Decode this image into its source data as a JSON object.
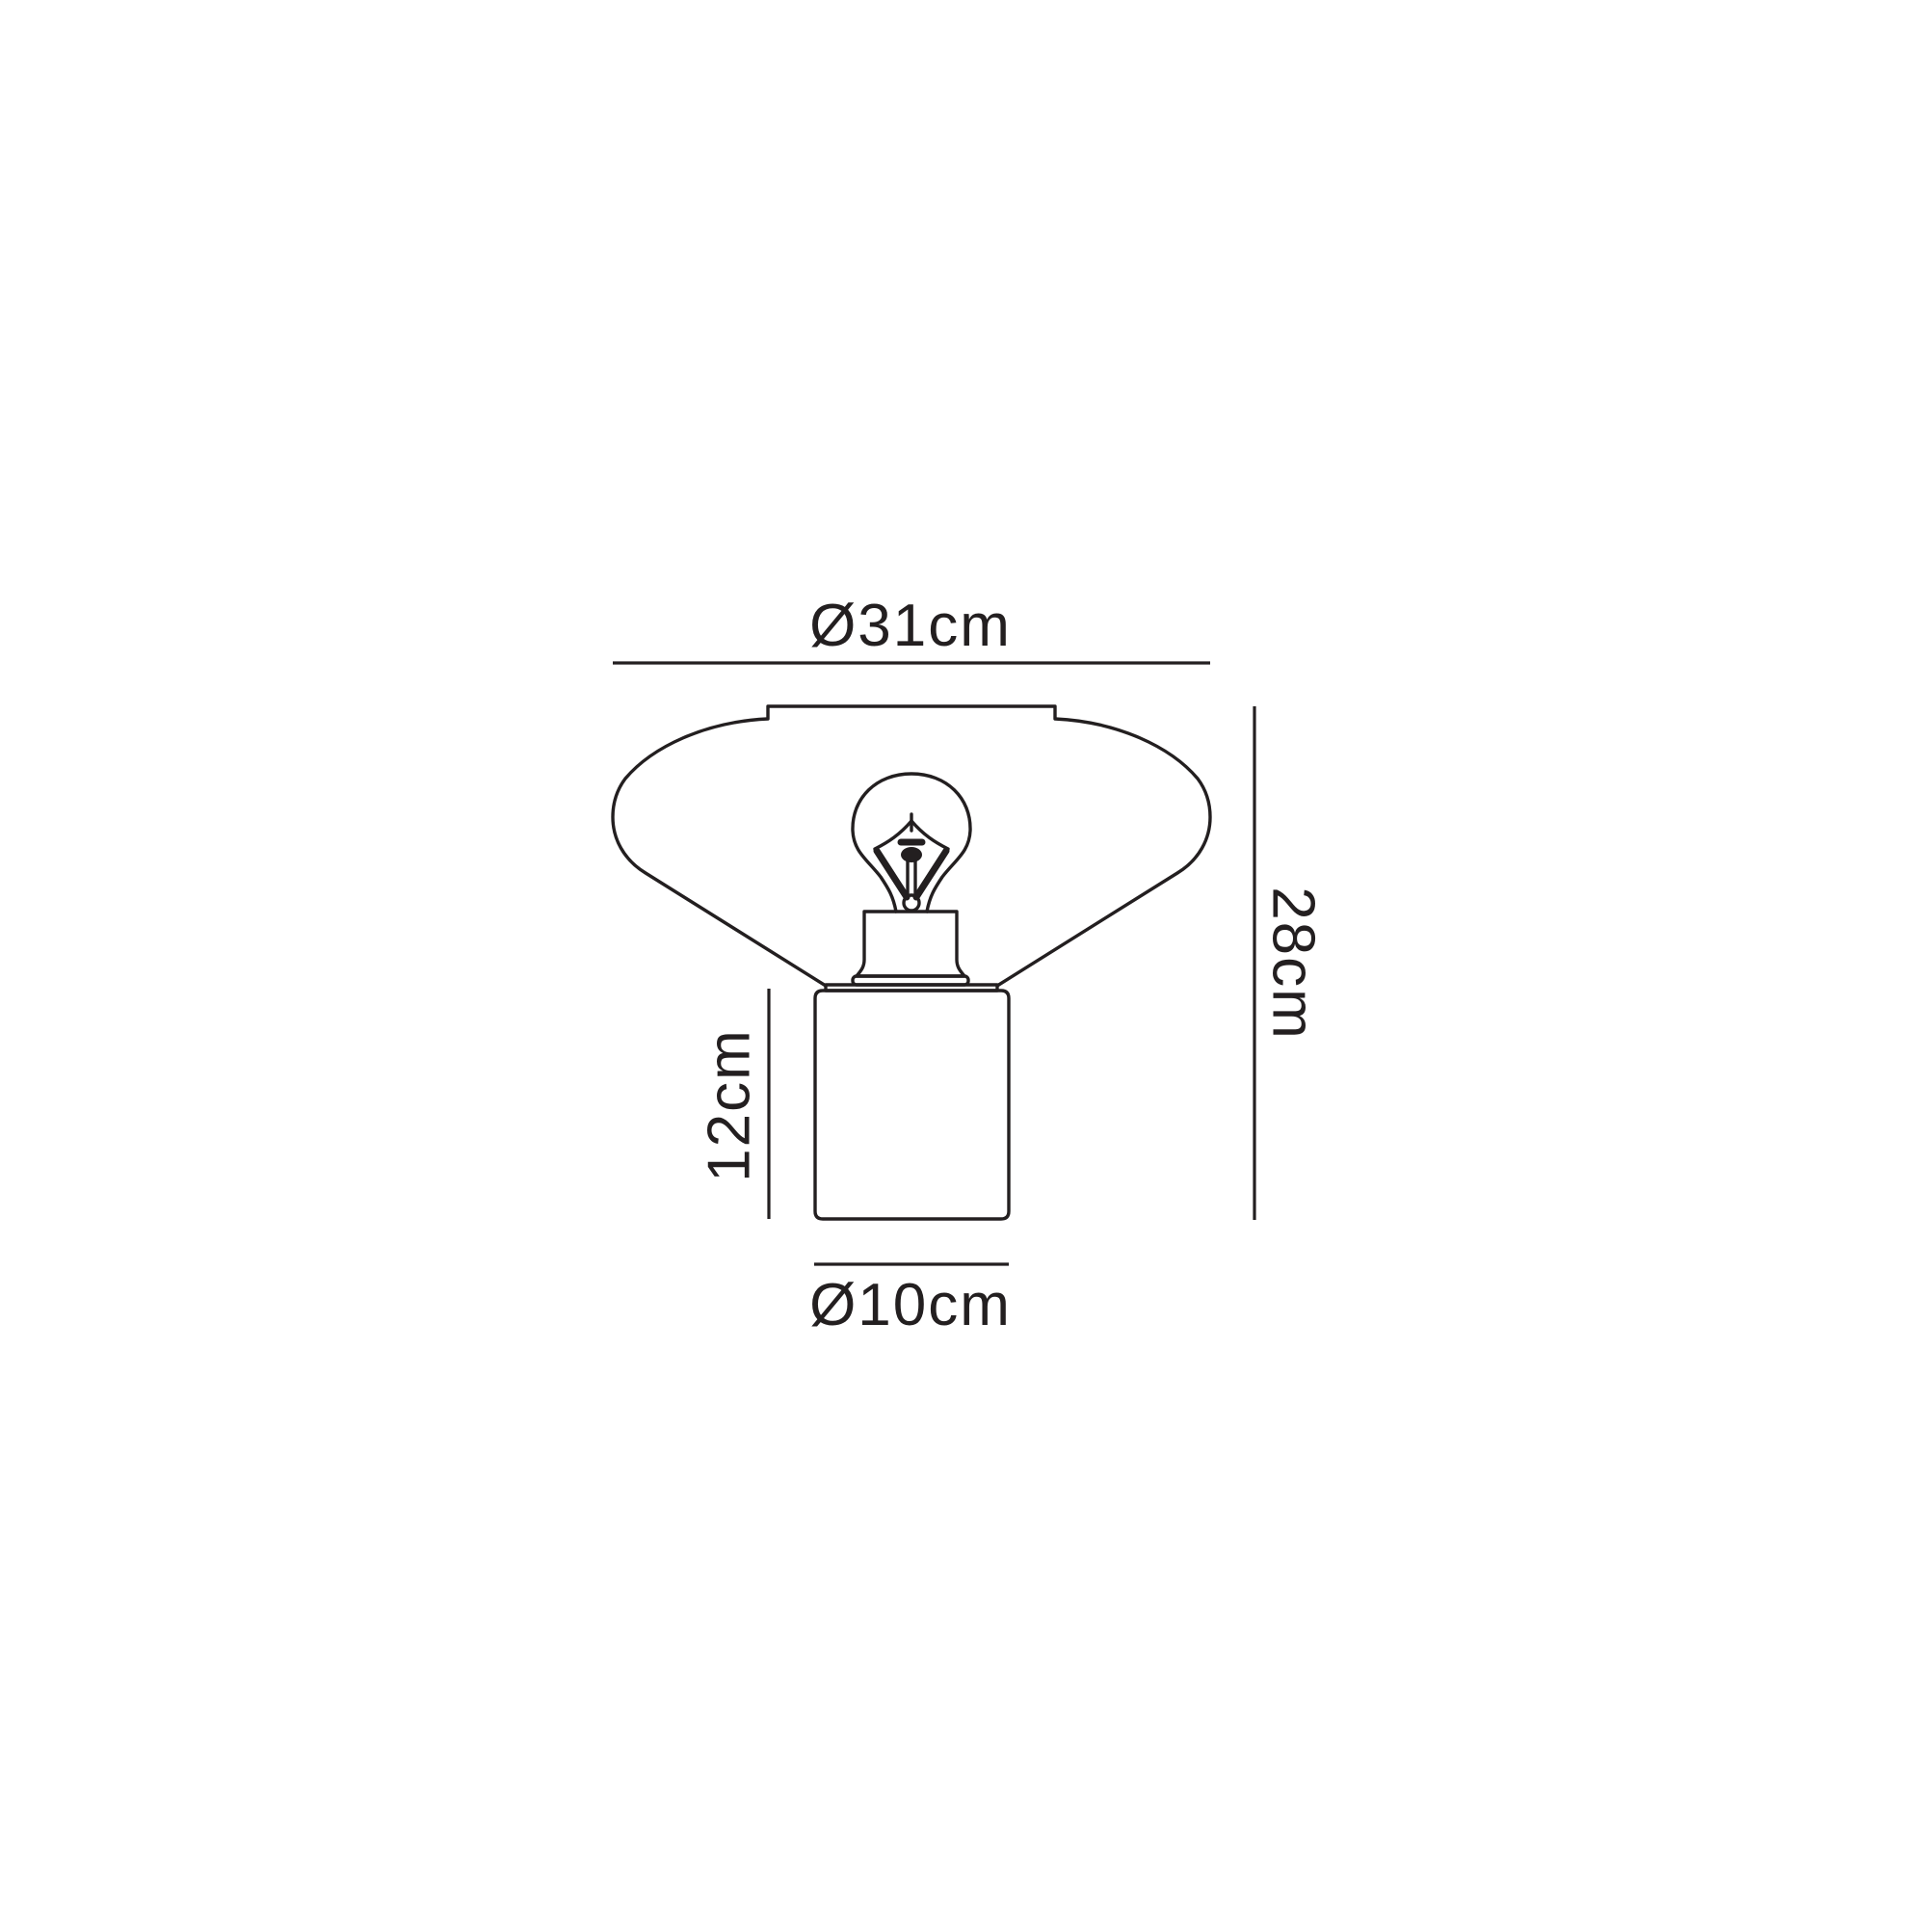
{
  "page": {
    "background_color": "#ffffff",
    "line_color": "#231f20",
    "description": "Technical dimension line drawing of a table lamp with wide conical glass shade, exposed filament bulb and cylindrical base"
  },
  "diagram": {
    "labels": {
      "shade_diameter": "Ø31cm",
      "total_height": "28cm",
      "base_height": "12cm",
      "base_diameter": "Ø10cm"
    }
  }
}
